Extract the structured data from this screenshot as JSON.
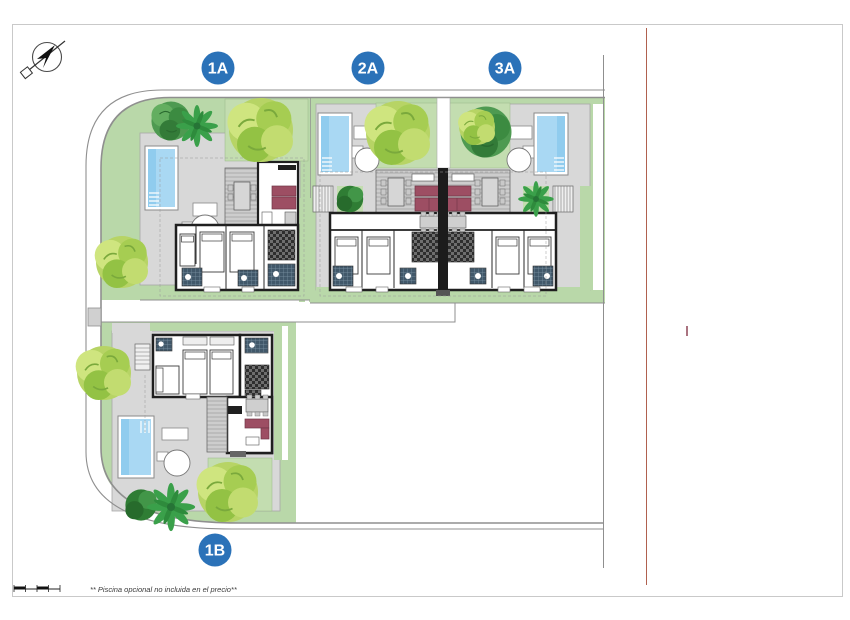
{
  "plan": {
    "type": "residential-site-plan",
    "compass": {
      "icon": "north-arrow"
    },
    "units": [
      {
        "label": "1A"
      },
      {
        "label": "2A"
      },
      {
        "label": "3A"
      },
      {
        "label": "1B"
      }
    ],
    "footnote": "** Piscina opcional no incluida en el precio**",
    "colors": {
      "badge_blue": "#2b72b8",
      "grass_green": "#b9d8a9",
      "garden_green": "#c3ddb0",
      "pavement_gray": "#d8d8d8",
      "pool_water_blue": "#a9d8f3",
      "wall_dark": "#1f1f1f",
      "sofa_maroon": "#9d4e63",
      "road_line_gray": "#8f8f8f",
      "right_boundary_red": "#b0614f",
      "tick_red": "#8e4455"
    }
  }
}
